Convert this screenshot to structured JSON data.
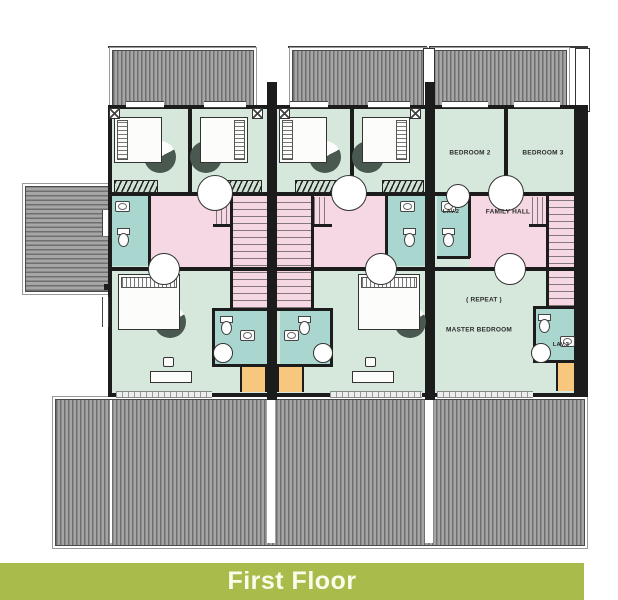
{
  "banner": {
    "label": "First Floor"
  },
  "floorplan": {
    "room_labels": {
      "bedroom2": "BEDROOM 2",
      "bedroom3": "BEDROOM 3",
      "lav2": "LAV.2",
      "family_hall": "FAMILY HALL",
      "repeat_note": "( REPEAT )",
      "master_bedroom": "MASTER BEDROOM",
      "lav3": "LAV.3"
    },
    "colors": {
      "wall": "#1c1c1c",
      "room_green": "#d6e8dc",
      "hall_pink": "#f5d8e3",
      "bath_teal": "#a9d6cf",
      "balcony_orange": "#f6c77d",
      "roof_gray": "#8d8d8d",
      "banner_green": "#a9bc4b",
      "banner_text": "#fbfcec"
    }
  }
}
